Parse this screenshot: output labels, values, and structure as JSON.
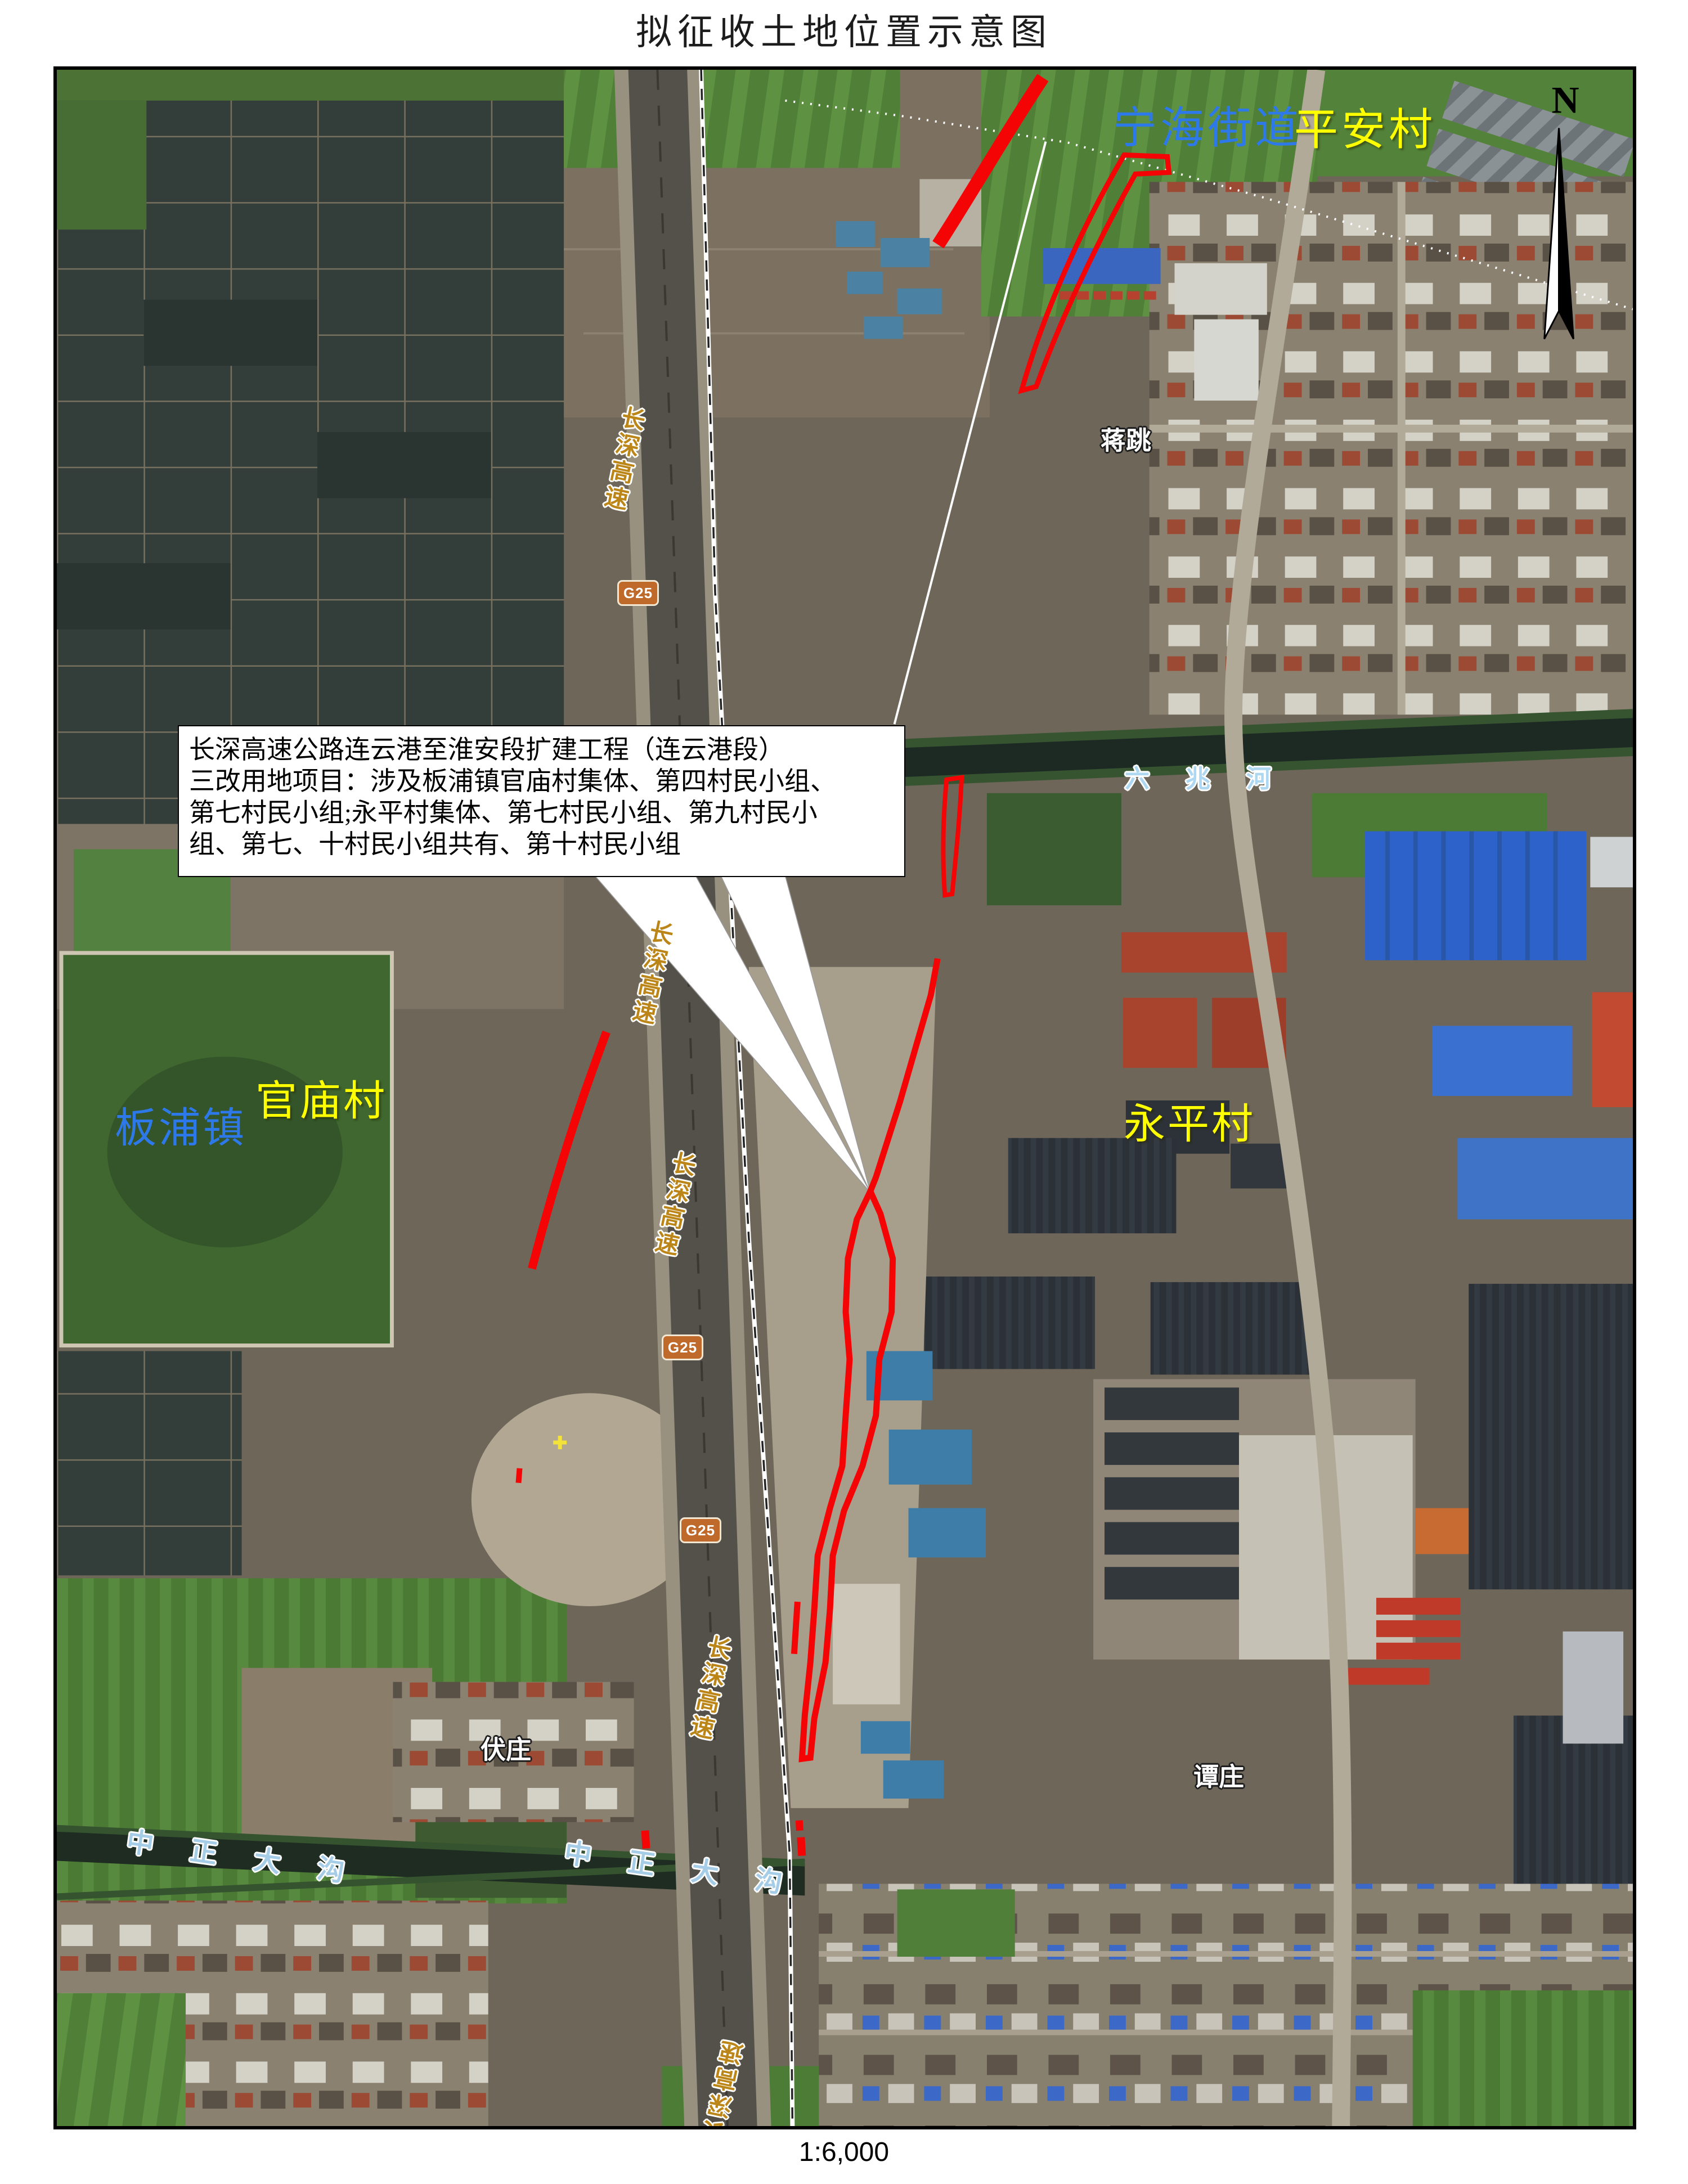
{
  "title": "拟征收土地位置示意图",
  "scale_label": "1:6,000",
  "north": {
    "label": "N"
  },
  "callout": {
    "lines": [
      "长深高速公路连云港至淮安段扩建工程（连云港段）",
      "三改用地项目：涉及板浦镇官庙村集体、第四村民小组、",
      "第七村民小组;永平村集体、第七村民小组、第九村民小",
      "组、第七、十村民小组共有、第十村民小组"
    ]
  },
  "map_labels": {
    "ninghai_street": "宁海街道",
    "pingan_village": "平安村",
    "banpu_town": "板浦镇",
    "guanmiao_village": "官庙村",
    "yongping_village": "永平村",
    "liuzhao_river": "六兆河",
    "jiangtiao": "蒋跳",
    "fuzhuang": "伏庄",
    "tanzhuang": "谭庄",
    "zhongzheng_ditch": "中正大沟",
    "changshen_expressway": "长深高速",
    "g25_shield": "G25"
  },
  "colors": {
    "town_label_blue": "#2e79ea",
    "village_label_yellow": "#ffff00",
    "water_label_blue": "#aed7f2",
    "road_label_orange": "#bb8518",
    "place_label_white": "#ffffff",
    "annotation_red": "#f40404",
    "g25_shield_orange": "#bf6a2a"
  }
}
